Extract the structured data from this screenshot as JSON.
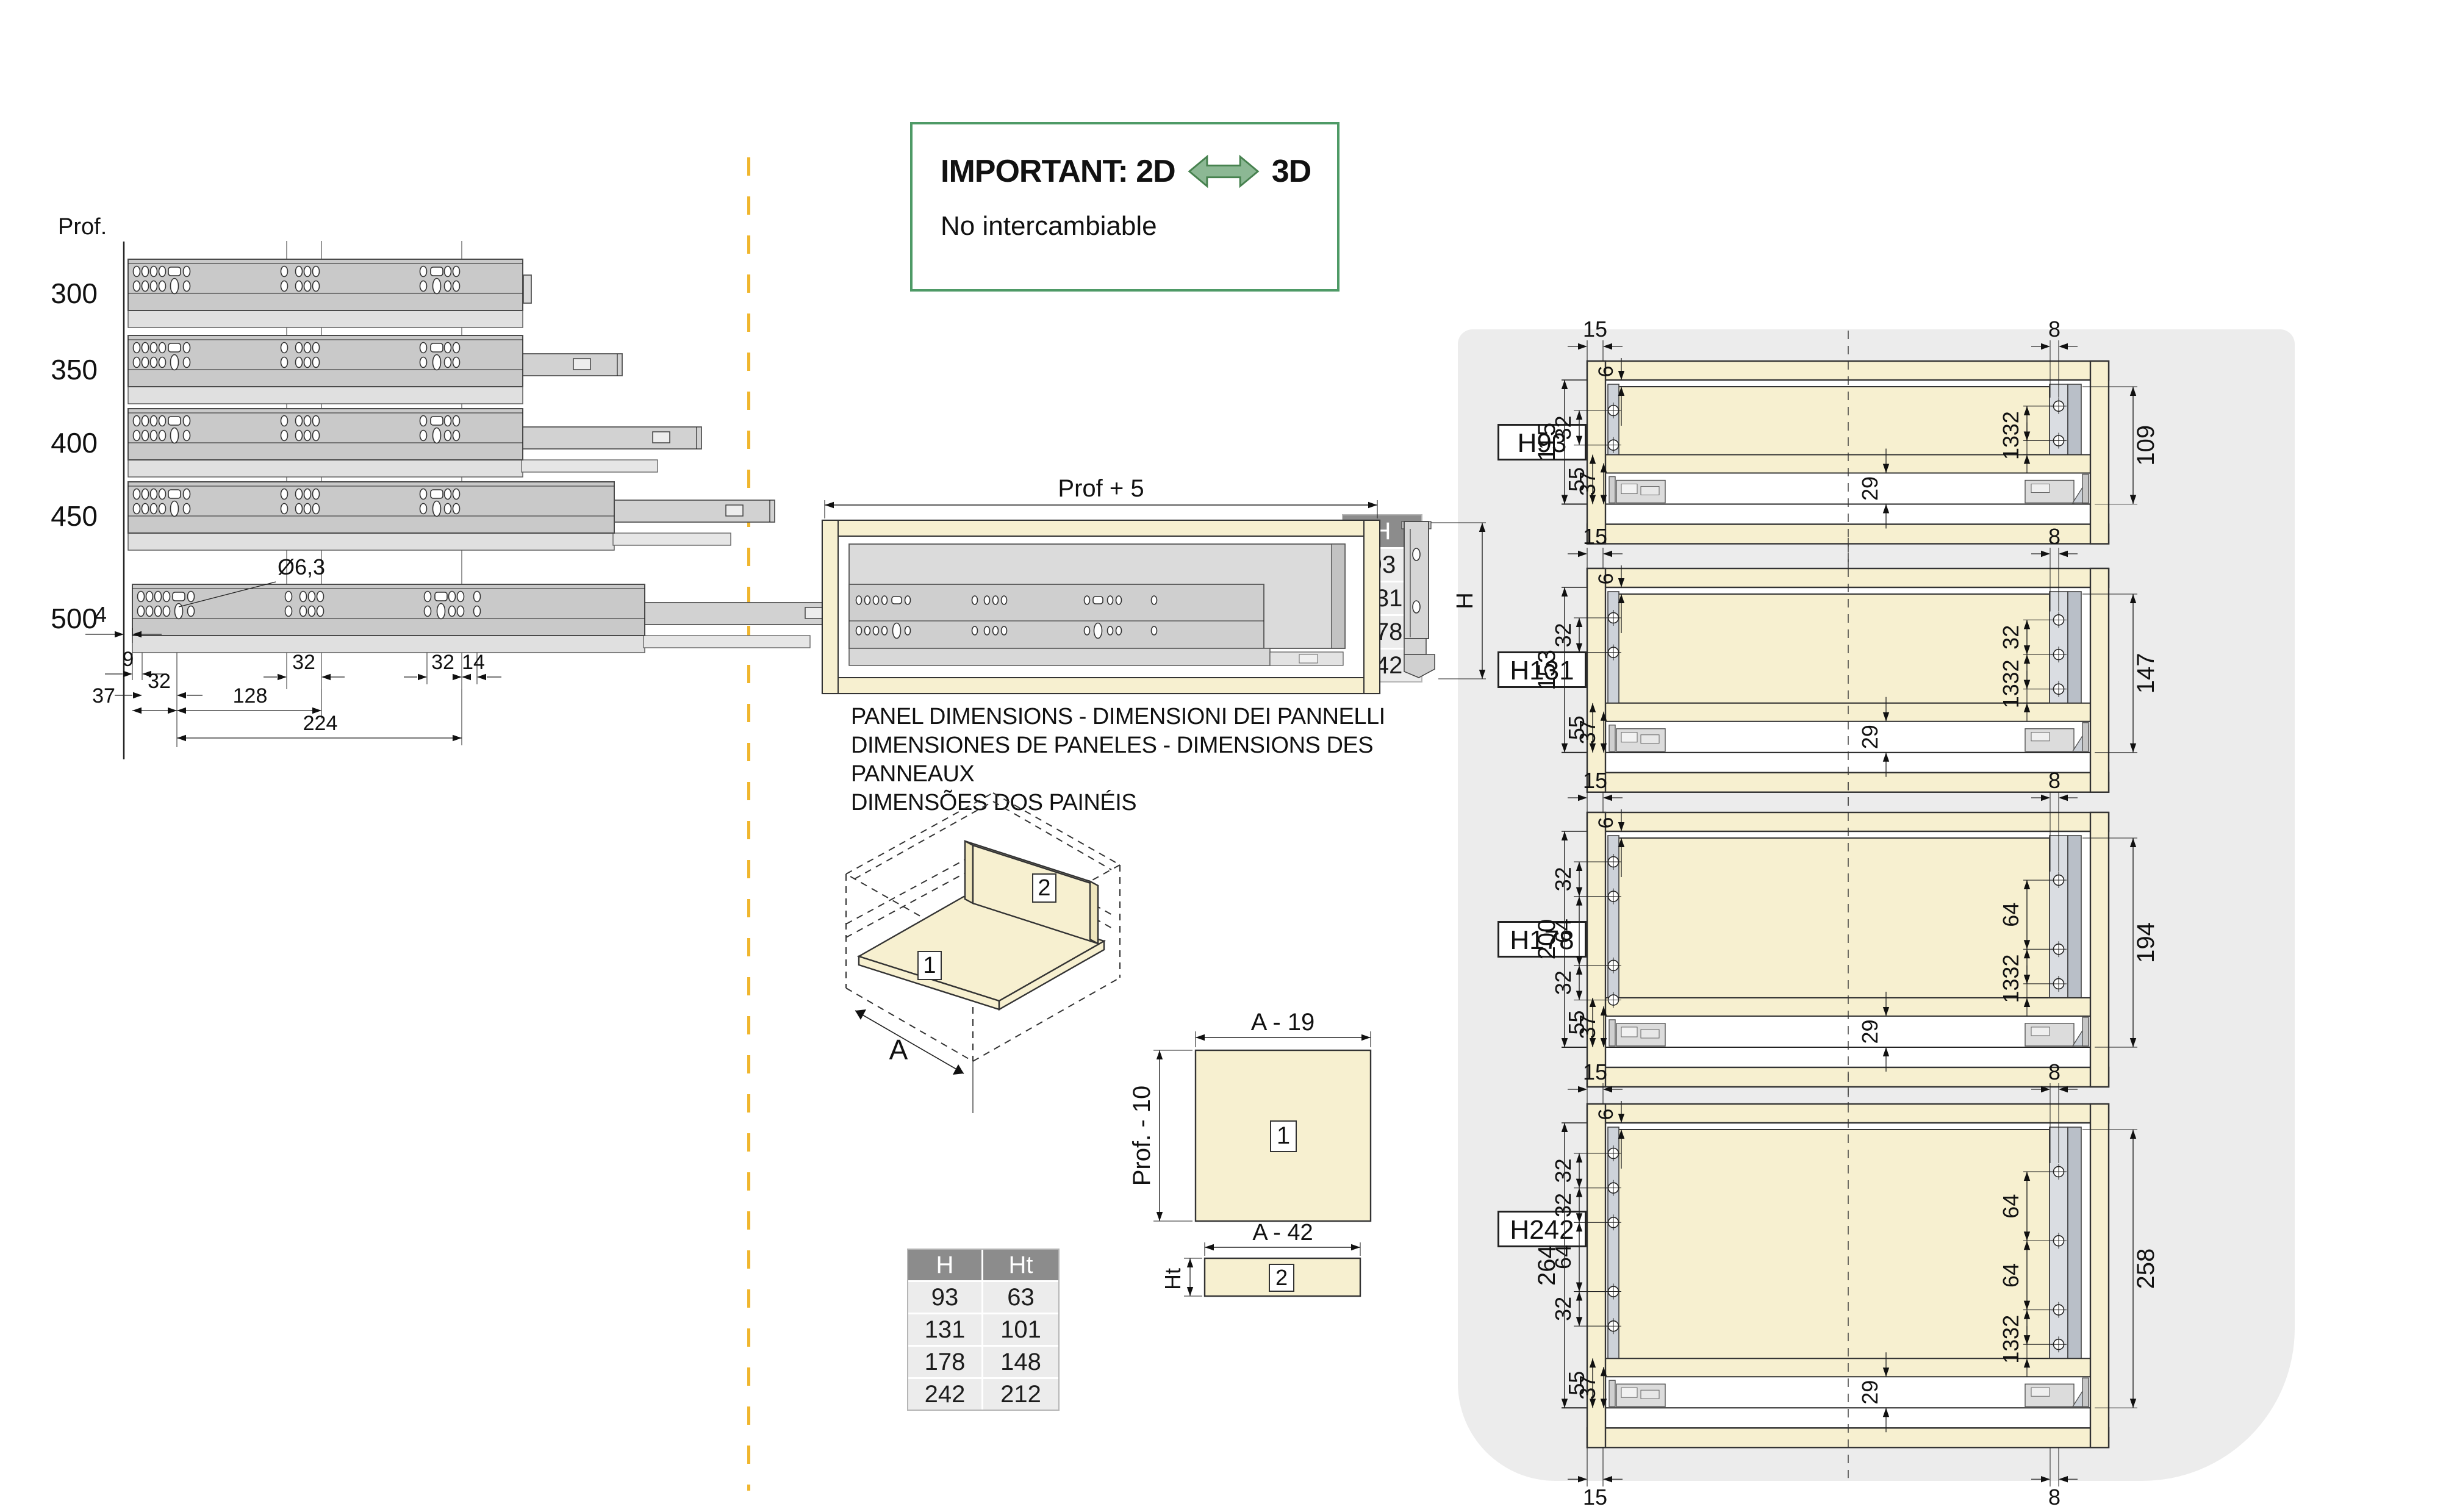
{
  "page": {
    "background": "#ffffff",
    "panel_background": "#ececec",
    "divider_yellow": "#f0b62e",
    "notice_green": "#4e9a66",
    "wood_cream": "#f7f0d0"
  },
  "left_diagram": {
    "axis_label": "Prof.",
    "lengths": [
      "300",
      "350",
      "400",
      "450",
      "500"
    ],
    "dim_front_gap": "4",
    "hole_diameter": "Ø6,3",
    "dim_first_hole": "9",
    "dim_pitch_left": "32",
    "dim_pitch_mid": "32",
    "dim_pitch_right": "32",
    "dim_end": "14",
    "dim_front": "37",
    "dim_mid_span": "128",
    "dim_total_span": "224"
  },
  "notice": {
    "title_left": "IMPORTANT: 2D",
    "title_right": "3D",
    "subtitle": "No intercambiable"
  },
  "drawer_view": {
    "width_dim": "Prof + 5",
    "height_dim": "H"
  },
  "h_table": {
    "header": "H",
    "rows": [
      "93",
      "131",
      "178",
      "242"
    ]
  },
  "panel_heading": [
    "PANEL DIMENSIONS - DIMENSIONI DEI PANNELLI",
    "DIMENSIONES DE PANELES - DIMENSIONS DES PANNEAUX",
    "DIMENSÕES DOS PAINÉIS"
  ],
  "iso": {
    "part1": "1",
    "part2": "2",
    "width_dim": "A"
  },
  "panel1": {
    "part": "1",
    "width_dim": "A - 19",
    "height_dim": "Prof. - 10"
  },
  "panel2": {
    "part": "2",
    "width_dim": "A - 42",
    "height_dim": "Ht"
  },
  "ht_table": {
    "headers": [
      "H",
      "Ht"
    ],
    "rows": [
      [
        "93",
        "63"
      ],
      [
        "131",
        "101"
      ],
      [
        "178",
        "148"
      ],
      [
        "242",
        "212"
      ]
    ]
  },
  "sections": [
    {
      "label": "H93",
      "dim_top_left": "15",
      "dim_top_right": "8",
      "dim_gap": "6",
      "left_chain": [
        "32"
      ],
      "overall_left": "115",
      "dim_55": "55",
      "dim_37": "37",
      "right_chain": [
        "32",
        "13"
      ],
      "overall_right": "109",
      "dim_29": "29"
    },
    {
      "label": "H131",
      "dim_top_left": "15",
      "dim_top_right": "8",
      "dim_gap": "6",
      "left_chain": [
        "32"
      ],
      "overall_left": "153",
      "dim_55": "55",
      "dim_37": "37",
      "right_chain": [
        "32",
        "32",
        "13"
      ],
      "overall_right": "147",
      "dim_29": "29"
    },
    {
      "label": "H178",
      "dim_top_left": "15",
      "dim_top_right": "8",
      "dim_gap": "6",
      "left_chain": [
        "32",
        "64",
        "32"
      ],
      "overall_left": "200",
      "dim_55": "55",
      "dim_37": "37",
      "right_chain": [
        "64",
        "32",
        "13"
      ],
      "overall_right": "194",
      "dim_29": "29"
    },
    {
      "label": "H242",
      "dim_top_left": "15",
      "dim_top_right": "8",
      "dim_gap": "6",
      "left_chain": [
        "32",
        "32",
        "64",
        "32"
      ],
      "overall_left": "264",
      "dim_55": "55",
      "dim_37": "37",
      "right_chain": [
        "64",
        "64",
        "32",
        "13"
      ],
      "overall_right": "258",
      "dim_29": "29",
      "bottom_labels": true
    }
  ]
}
